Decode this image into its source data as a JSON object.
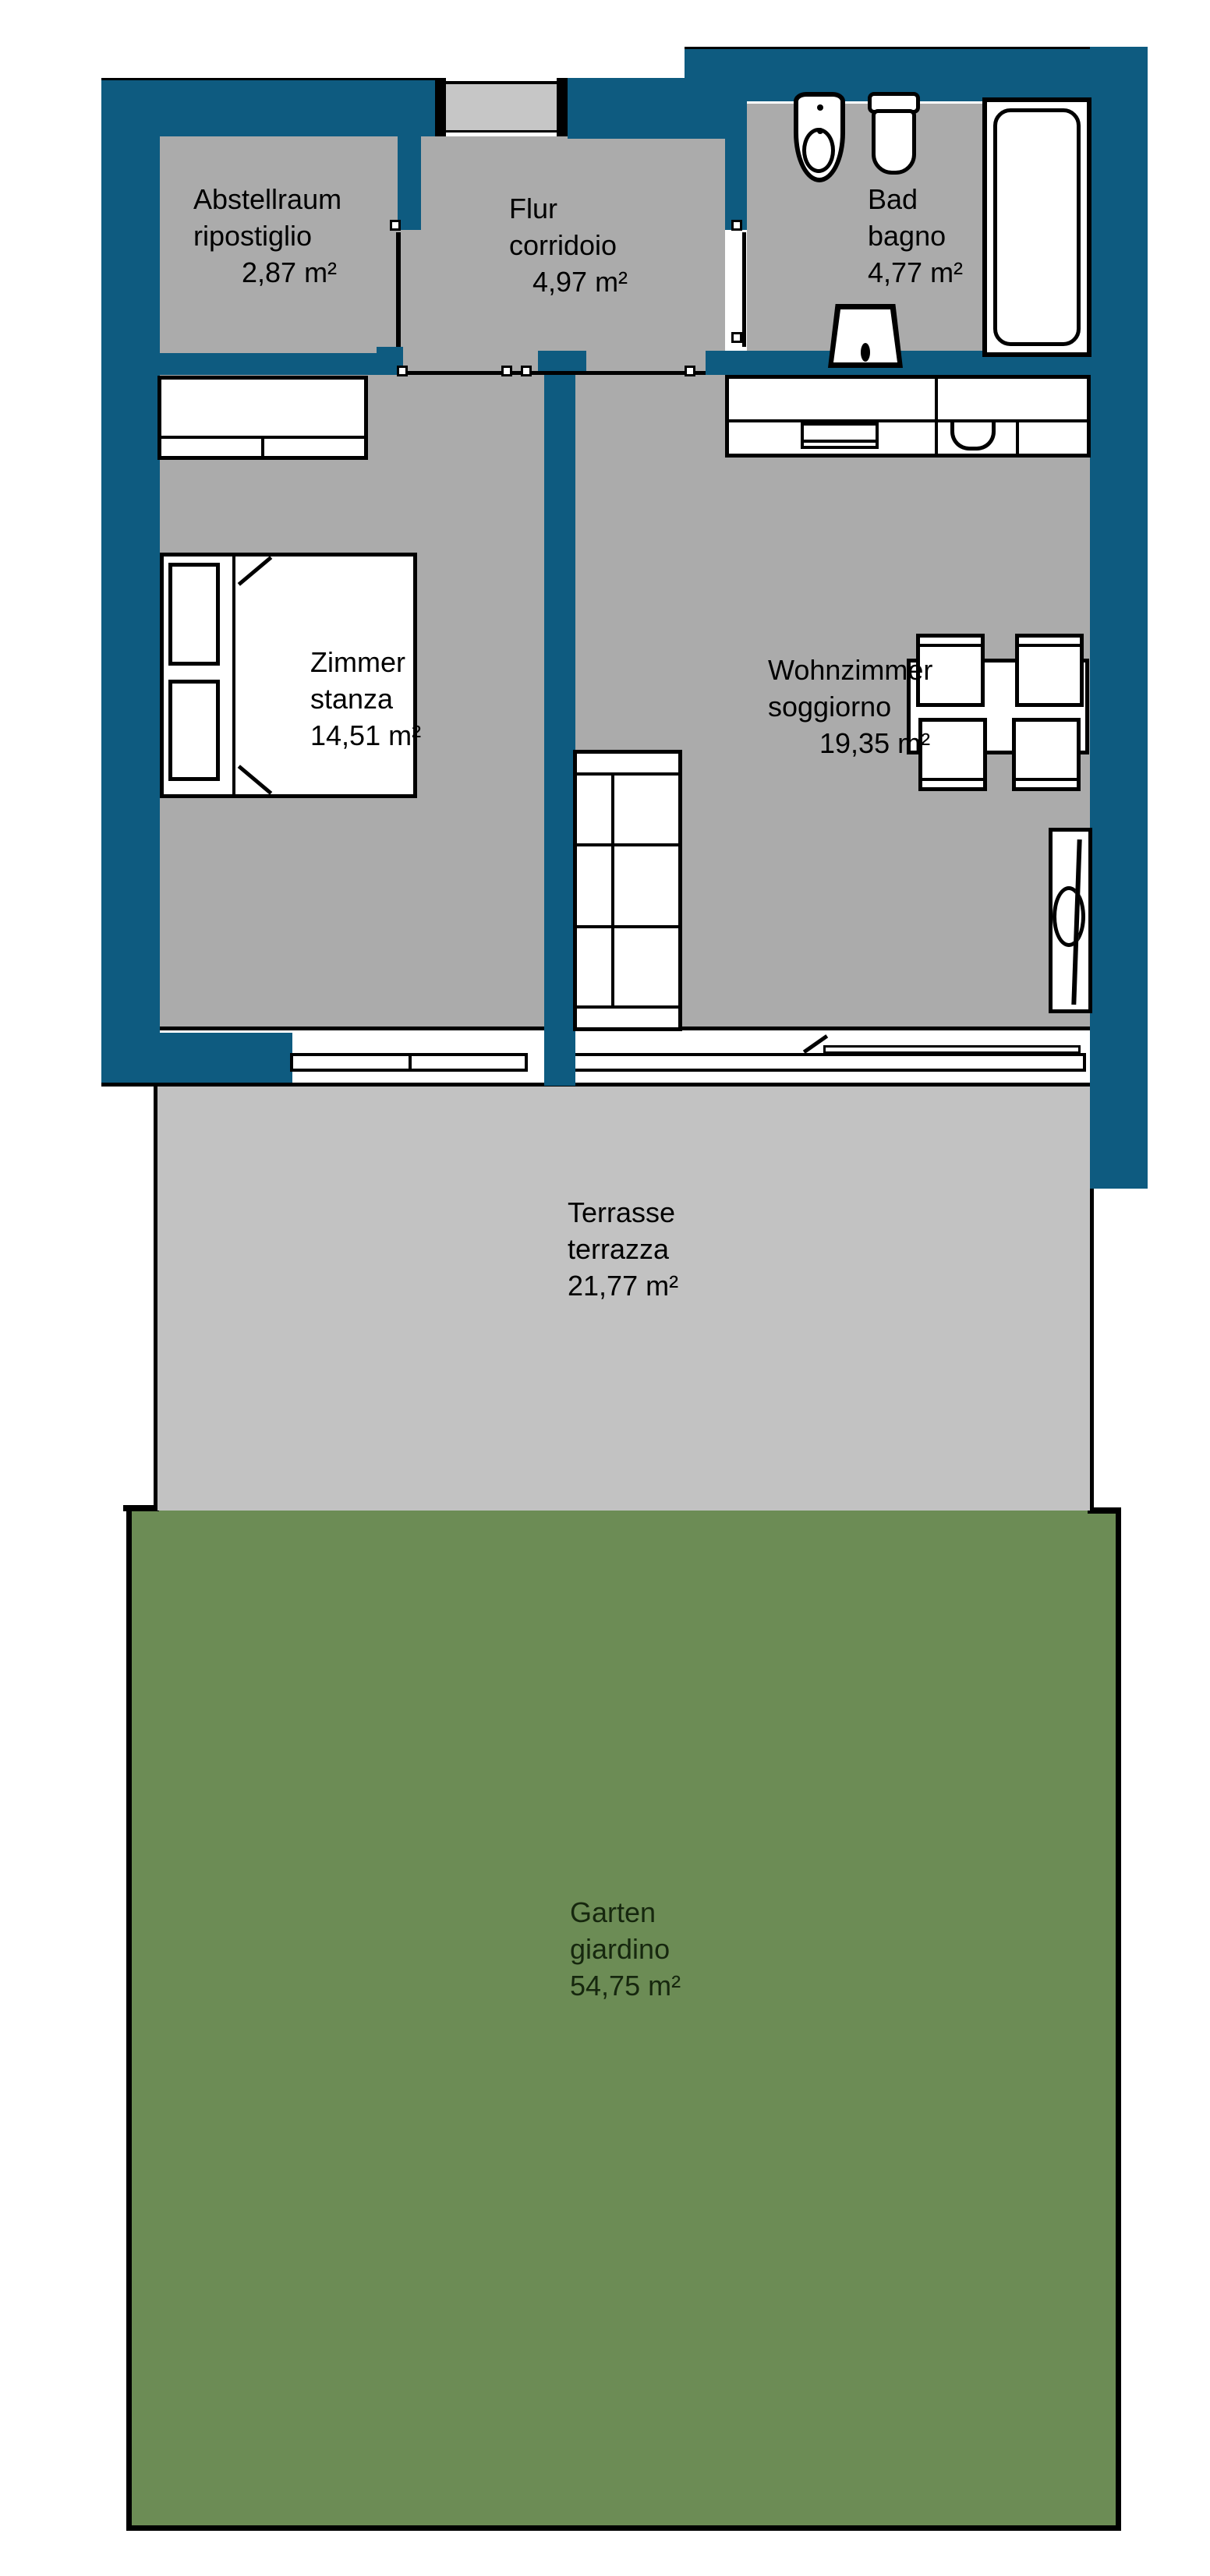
{
  "title": "Wohnung Grundriss / floor plan",
  "colors": {
    "wall": "#0E5B80",
    "floor": "#ABABAB",
    "terrace": "#C2C2C2",
    "garden": "#6C8C55",
    "door_panel": "#C6C6C6",
    "line": "#000000",
    "background": "#FFFFFF",
    "garden_text": "#16270E"
  },
  "rooms": {
    "abstellraum": {
      "line1": "Abstellraum",
      "line2": "ripostiglio",
      "area": "2,87 m²"
    },
    "flur": {
      "line1": "Flur",
      "line2": "corridoio",
      "area": "4,97 m²"
    },
    "bad": {
      "line1": "Bad",
      "line2": "bagno",
      "area": "4,77 m²"
    },
    "zimmer": {
      "line1": "Zimmer",
      "line2": "stanza",
      "area": "14,51 m²"
    },
    "wohnzimmer": {
      "line1": "Wohnzimmer",
      "line2": "soggiorno",
      "area": "19,35 m²"
    },
    "terrasse": {
      "line1": "Terrasse",
      "line2": "terrazza",
      "area": "21,77 m²"
    },
    "garten": {
      "line1": "Garten",
      "line2": "giardino",
      "area": "54,75 m²"
    }
  }
}
